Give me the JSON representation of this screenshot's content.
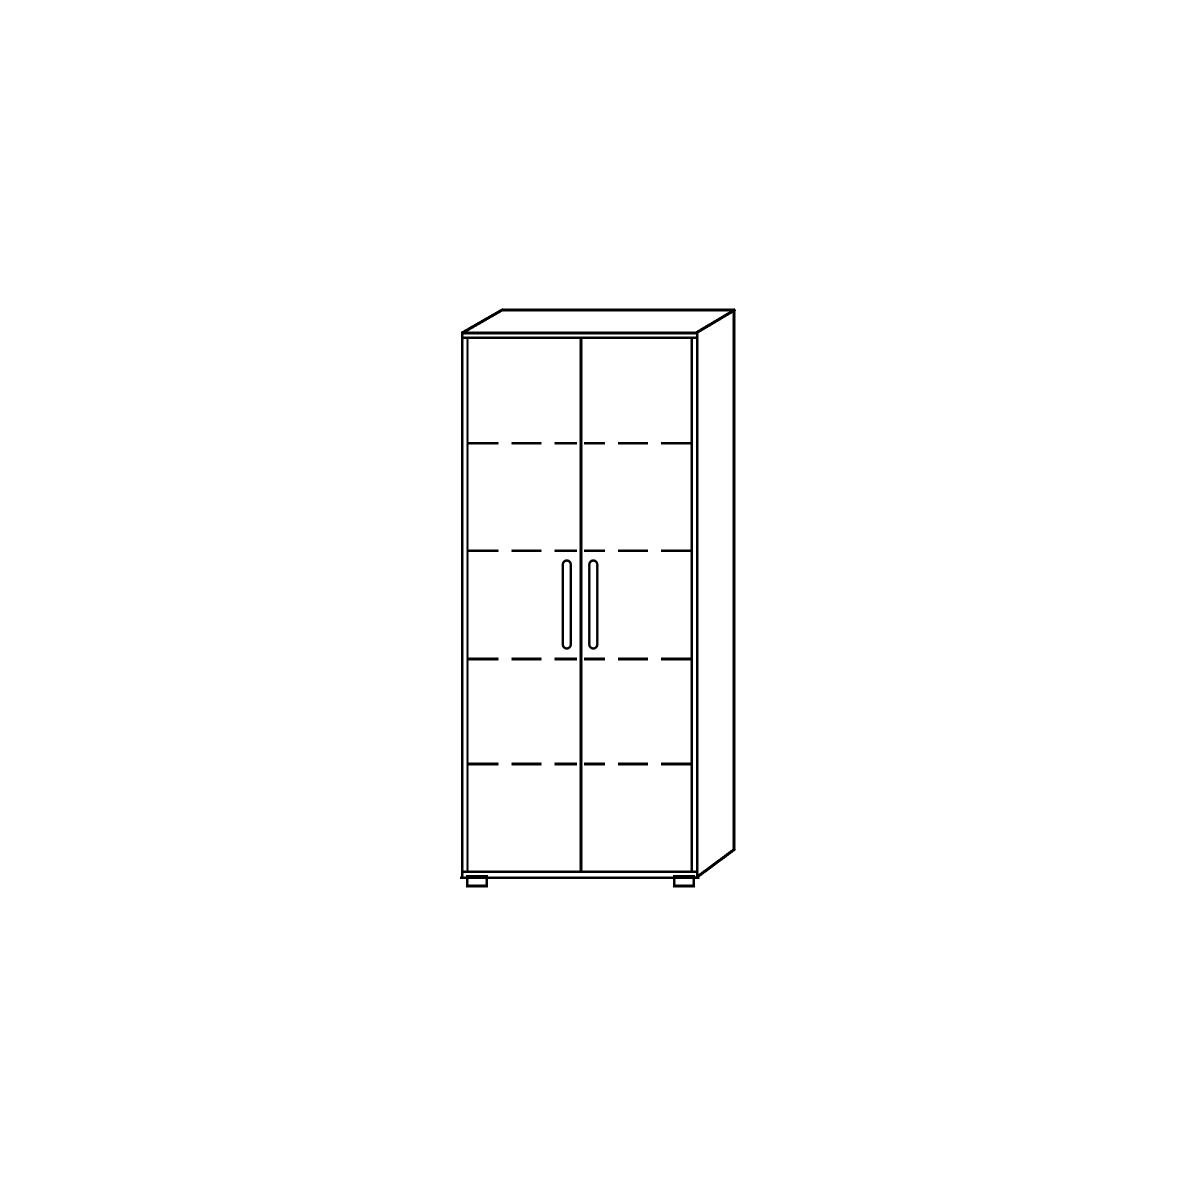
{
  "page": {
    "width": 1200,
    "height": 1200,
    "background_color": "#ffffff"
  },
  "illustration": {
    "name": "two-door-cabinet-technical-line-drawing",
    "stroke_color": "#000000",
    "fill_color": "#ffffff",
    "dash_pattern": "30 13",
    "dashed_stroke_width": 2.6,
    "solid_lines": [
      {
        "name": "top-back-edge",
        "x1": 501.5,
        "y1": 310,
        "x2": 735,
        "y2": 310,
        "w": 3
      },
      {
        "name": "top-left-diagonal",
        "x1": 462,
        "y1": 333,
        "x2": 503,
        "y2": 309.5,
        "w": 3
      },
      {
        "name": "top-right-diagonal",
        "x1": 696,
        "y1": 333,
        "x2": 735.5,
        "y2": 309.5,
        "w": 3
      },
      {
        "name": "side-back-edge",
        "x1": 733.8,
        "y1": 309,
        "x2": 733.8,
        "y2": 850,
        "w": 3
      },
      {
        "name": "side-bottom-diagonal",
        "x1": 696.5,
        "y1": 877.5,
        "x2": 735.2,
        "y2": 848.8,
        "w": 3
      },
      {
        "name": "top-front-edge-outer",
        "x1": 460.8,
        "y1": 333,
        "x2": 698.5,
        "y2": 333,
        "w": 2.8
      },
      {
        "name": "top-front-edge-inner",
        "x1": 462,
        "y1": 337.8,
        "x2": 697,
        "y2": 337.8,
        "w": 2.4
      },
      {
        "name": "left-side-front-edge",
        "x1": 462.3,
        "y1": 331.8,
        "x2": 462.3,
        "y2": 879,
        "w": 2.8
      },
      {
        "name": "left-door-outer-edge",
        "x1": 467.5,
        "y1": 336.6,
        "x2": 467.5,
        "y2": 873,
        "w": 2.2
      },
      {
        "name": "right-side-front-edge",
        "x1": 697.3,
        "y1": 331.8,
        "x2": 697.3,
        "y2": 879,
        "w": 2.8
      },
      {
        "name": "right-door-outer-edge",
        "x1": 691.8,
        "y1": 336.6,
        "x2": 691.8,
        "y2": 873,
        "w": 2.4
      },
      {
        "name": "center-door-divider",
        "x1": 580.8,
        "y1": 336.6,
        "x2": 580.8,
        "y2": 873,
        "w": 3
      },
      {
        "name": "doors-bottom-edge",
        "x1": 460.8,
        "y1": 871.8,
        "x2": 698.5,
        "y2": 871.8,
        "w": 2.6
      },
      {
        "name": "plinth-bottom-edge",
        "x1": 459.8,
        "y1": 877.8,
        "x2": 699.3,
        "y2": 877.8,
        "w": 2.8
      }
    ],
    "dashed_shelf_lines": [
      {
        "name": "shelf-line-1-left-door",
        "x1": 468.5,
        "y1": 443.3,
        "x2": 577,
        "y2": 443.3
      },
      {
        "name": "shelf-line-1-right-door",
        "x1": 690.8,
        "y1": 443.3,
        "x2": 584,
        "y2": 443.3
      },
      {
        "name": "shelf-line-2-left-door",
        "x1": 468.5,
        "y1": 550.8,
        "x2": 577,
        "y2": 550.8
      },
      {
        "name": "shelf-line-2-right-door",
        "x1": 690.8,
        "y1": 550.8,
        "x2": 584,
        "y2": 550.8
      },
      {
        "name": "shelf-line-3-left-door",
        "x1": 468.5,
        "y1": 659,
        "x2": 577,
        "y2": 659
      },
      {
        "name": "shelf-line-3-right-door",
        "x1": 690.8,
        "y1": 659,
        "x2": 584,
        "y2": 659
      },
      {
        "name": "shelf-line-4-left-door",
        "x1": 468.5,
        "y1": 764,
        "x2": 577,
        "y2": 764
      },
      {
        "name": "shelf-line-4-right-door",
        "x1": 690.8,
        "y1": 764,
        "x2": 584,
        "y2": 764
      }
    ],
    "handles": [
      {
        "name": "left-door-handle",
        "x": 562.8,
        "y": 560.5,
        "width": 8,
        "height": 88,
        "radius": 4,
        "stroke_width": 2.4
      },
      {
        "name": "right-door-handle",
        "x": 589.3,
        "y": 560.5,
        "width": 8,
        "height": 88,
        "radius": 4,
        "stroke_width": 2.4
      }
    ],
    "feet": [
      {
        "name": "left-foot",
        "x": 467.3,
        "y": 876.5,
        "width": 19.5,
        "height": 9.5,
        "stroke_width": 2.8
      },
      {
        "name": "right-foot",
        "x": 674.3,
        "y": 876.5,
        "width": 19.5,
        "height": 9.5,
        "stroke_width": 2.8
      }
    ]
  }
}
